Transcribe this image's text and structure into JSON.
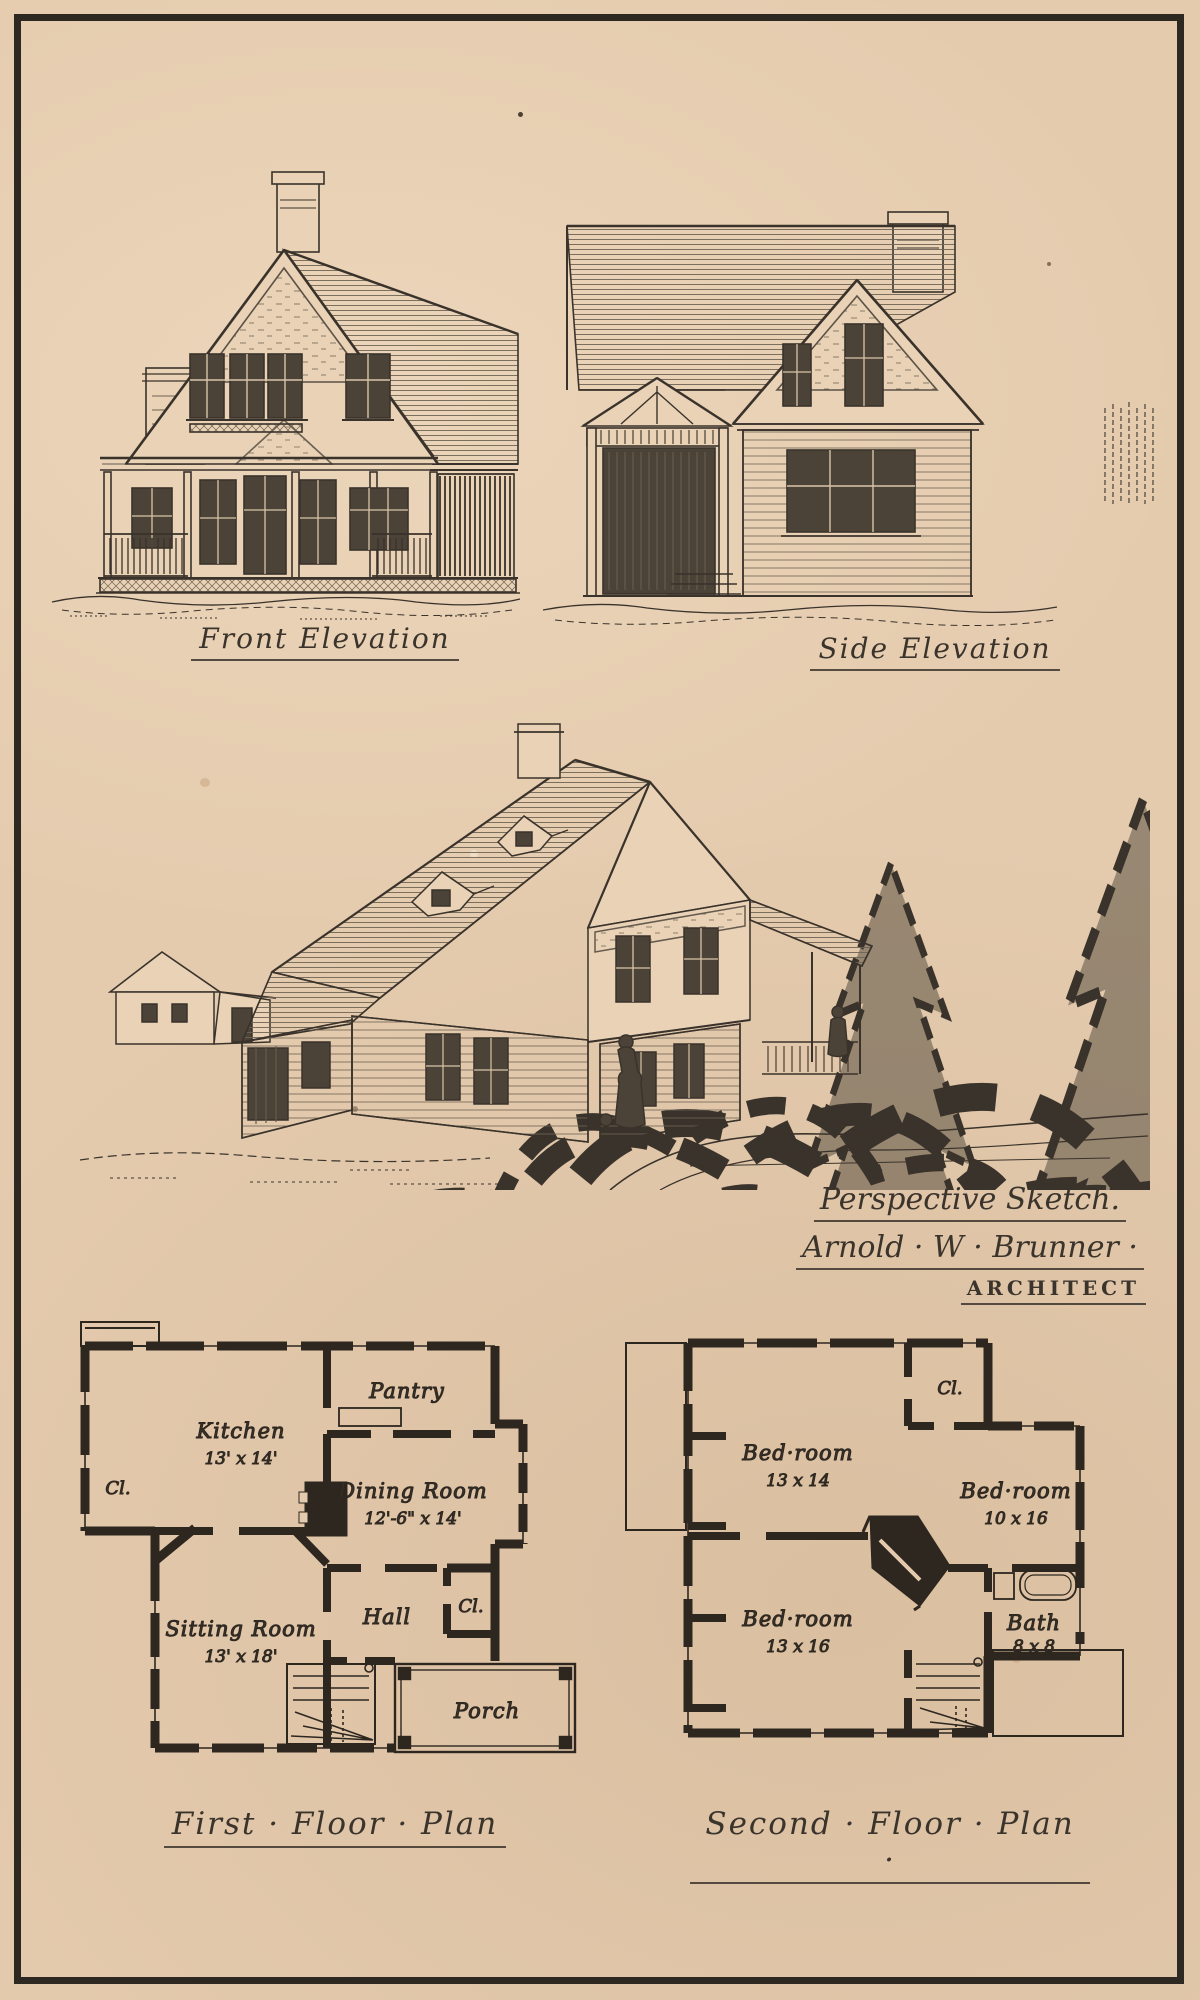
{
  "page": {
    "paper_color": "#e5cbae",
    "ink_color": "#3a332b",
    "frame_color": "#2d2822"
  },
  "elevations": {
    "front_caption": "Front Elevation",
    "side_caption": "Side Elevation"
  },
  "perspective": {
    "caption": "Perspective Sketch.",
    "architect_name": "Arnold · W · Brunner ·",
    "architect_title": "ARCHITECT"
  },
  "first_floor_plan": {
    "caption": "First · Floor · Plan",
    "rooms": {
      "kitchen": {
        "name": "Kitchen",
        "dims": "13' x 14'"
      },
      "pantry": {
        "name": "Pantry",
        "dims": ""
      },
      "closet_left": {
        "name": "Cl.",
        "dims": ""
      },
      "dining": {
        "name": "Dining Room",
        "dims": "12'-6\" x 14'"
      },
      "sitting": {
        "name": "Sitting Room",
        "dims": "13' x 18'"
      },
      "hall": {
        "name": "Hall",
        "dims": ""
      },
      "closet_right": {
        "name": "Cl.",
        "dims": ""
      },
      "porch": {
        "name": "Porch",
        "dims": ""
      }
    }
  },
  "second_floor_plan": {
    "caption": "Second · Floor · Plan ·",
    "rooms": {
      "bedroom_13x14": {
        "name": "Bed·room",
        "dims": "13 x 14"
      },
      "closet": {
        "name": "Cl.",
        "dims": ""
      },
      "bedroom_10x16": {
        "name": "Bed·room",
        "dims": "10 x 16"
      },
      "bedroom_13x16": {
        "name": "Bed·room",
        "dims": "13 x 16"
      },
      "bath": {
        "name": "Bath",
        "dims": "8 x 8"
      }
    }
  }
}
